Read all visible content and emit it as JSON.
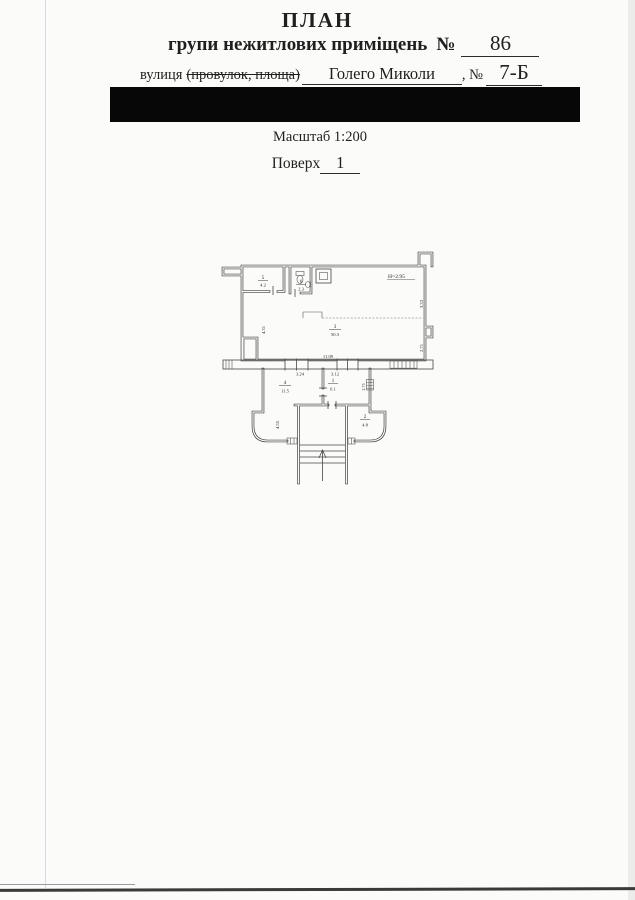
{
  "header": {
    "title": "ПЛАН",
    "subtitle": "групи нежитлових приміщень",
    "premises_no_label": "№",
    "premises_no_value": "86",
    "street_label": "вулиця",
    "street_struck": "(провулок, площа)",
    "street_value": "Голего Миколи",
    "comma_no": ", №",
    "building_no_value": "7-Б"
  },
  "meta": {
    "scale_label": "Масштаб 1:200",
    "floor_label": "Поверх",
    "floor_value": "1"
  },
  "plan": {
    "height_label": "Н=2.95",
    "dims": {
      "right_top": "3.33",
      "right_bottom": "2.71",
      "left": "4.31",
      "bottom_total": "11.09",
      "bottom_left": "3.24",
      "bottom_mid": "3.12",
      "vest_right": "1.71",
      "vest_left": "4.55"
    },
    "rooms": [
      {
        "num": "5",
        "area": "4.2"
      },
      {
        "num": "6",
        "area": "2.3"
      },
      {
        "num": "3",
        "area": "50.3"
      },
      {
        "num": "4",
        "area": "11.5"
      },
      {
        "num": "1",
        "area": "6.1"
      },
      {
        "num": "2",
        "area": "4.8"
      }
    ]
  },
  "colors": {
    "ink": "#1f1f1f",
    "wall": "#3f3f3f",
    "redaction": "#070707"
  }
}
